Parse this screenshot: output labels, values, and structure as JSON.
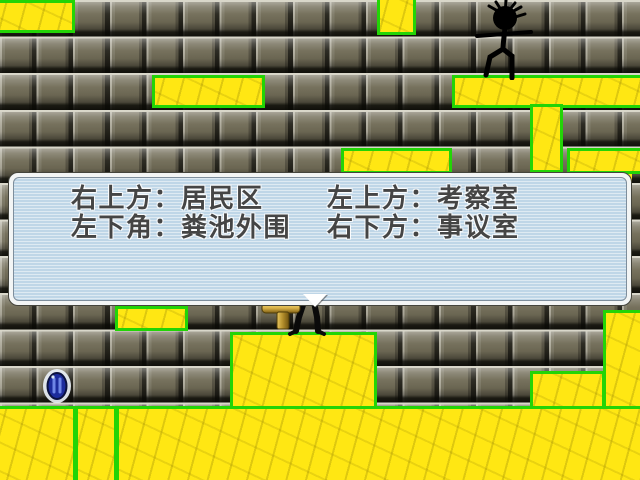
{
  "game": {
    "dialog": {
      "lines": [
        {
          "left": "右上方：居民区",
          "right": "左上方：考察室"
        },
        {
          "left": "左下角：粪池外围",
          "right": "右下方：事议室"
        }
      ],
      "more_indicator_shape": "down-triangle"
    },
    "colors": {
      "platform_fill": "#ffe713",
      "platform_border": "#23d406",
      "brick_face": "#716c57",
      "dialog_tint": "#a8c8e1",
      "dialog_text": "#454545",
      "gem_blue": "#1c2c9c",
      "hammer_gold": "#d9b249"
    },
    "sprites": [
      {
        "name": "hero-stick-figure",
        "location": "top-right-platform"
      },
      {
        "name": "npc-behind-dialog",
        "location": "center-below-dialog"
      },
      {
        "name": "hammer-item",
        "location": "center-ledge"
      },
      {
        "name": "blue-gem",
        "location": "lower-left"
      }
    ],
    "platforms": [
      {
        "id": "top-left",
        "x": -6,
        "y": 0,
        "w": 81,
        "h": 33,
        "style": "block"
      },
      {
        "id": "upper-mid",
        "x": 152,
        "y": 75,
        "w": 113,
        "h": 33,
        "style": "block"
      },
      {
        "id": "top-small",
        "x": 377,
        "y": -8,
        "w": 39,
        "h": 43,
        "style": "block"
      },
      {
        "id": "top-right-long",
        "x": 452,
        "y": 75,
        "w": 200,
        "h": 33,
        "style": "block"
      },
      {
        "id": "right-column",
        "x": 530,
        "y": 104,
        "w": 33,
        "h": 69,
        "style": "block"
      },
      {
        "id": "mid-shelf",
        "x": 341,
        "y": 148,
        "w": 111,
        "h": 26,
        "style": "block"
      },
      {
        "id": "mid-shelf-under",
        "x": 345,
        "y": 174,
        "w": 85,
        "h": 59,
        "style": "patch"
      },
      {
        "id": "right-shelf",
        "x": 567,
        "y": 148,
        "w": 85,
        "h": 26,
        "style": "block"
      },
      {
        "id": "right-shelf-under",
        "x": 570,
        "y": 174,
        "w": 62,
        "h": 48,
        "style": "patch"
      },
      {
        "id": "behind-dialog-a",
        "x": 8,
        "y": 190,
        "w": 54,
        "h": 78,
        "style": "patch"
      },
      {
        "id": "behind-dialog-b",
        "x": 62,
        "y": 224,
        "w": 53,
        "h": 44,
        "style": "patch"
      },
      {
        "id": "below-dialog-small",
        "x": 115,
        "y": 306,
        "w": 73,
        "h": 25,
        "style": "block"
      },
      {
        "id": "mid-big",
        "x": 230,
        "y": 332,
        "w": 147,
        "h": 77,
        "style": "block"
      },
      {
        "id": "step-right",
        "x": 530,
        "y": 371,
        "w": 75,
        "h": 38,
        "style": "block"
      },
      {
        "id": "right-lower-column",
        "x": 603,
        "y": 310,
        "w": 49,
        "h": 99,
        "style": "block"
      },
      {
        "id": "bottom-left",
        "x": -6,
        "y": 406,
        "w": 82,
        "h": 80,
        "style": "block"
      },
      {
        "id": "bottom-mid-strip",
        "x": 75,
        "y": 406,
        "w": 42,
        "h": 80,
        "style": "block"
      },
      {
        "id": "bottom-wide",
        "x": 116,
        "y": 406,
        "w": 536,
        "h": 80,
        "style": "block"
      }
    ]
  }
}
